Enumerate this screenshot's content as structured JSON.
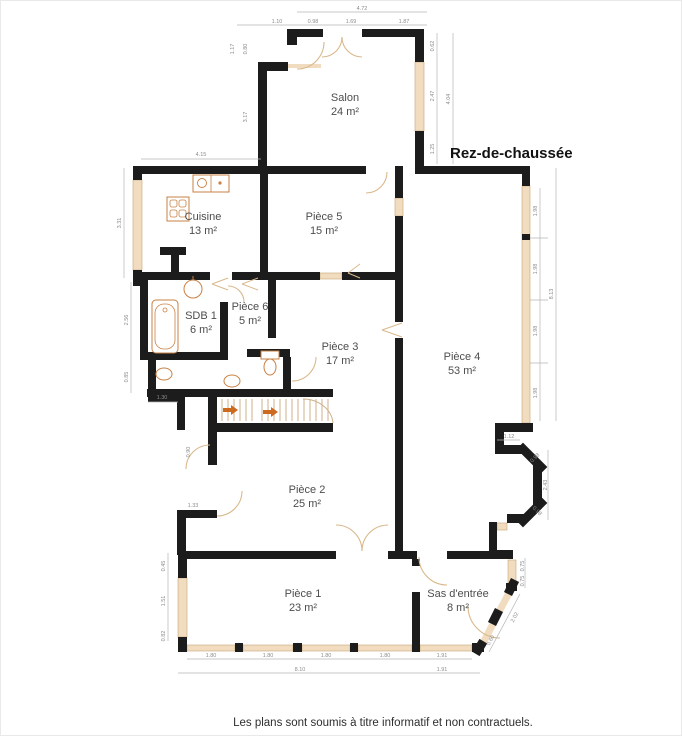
{
  "title": "Rez-de-chaussée",
  "disclaimer": "Les plans sont soumis à titre informatif et non contractuels.",
  "colors": {
    "wall": "#1c1c1c",
    "window": "#f2dcc0",
    "window_border": "#c3a678",
    "door": "#d9b98c",
    "fixture": "#c98145",
    "stair_stripe": "#cdb08a",
    "arrow": "#cc6a1f",
    "dim_line": "#b5b5b5",
    "dim_text": "#8c8c8c",
    "room_text": "#4d4d4d"
  },
  "rooms": [
    {
      "name": "Salon",
      "area": "24 m²",
      "x": 345,
      "y": 101
    },
    {
      "name": "Cuisine",
      "area": "13 m²",
      "x": 203,
      "y": 220
    },
    {
      "name": "Pièce 5",
      "area": "15 m²",
      "x": 324,
      "y": 220
    },
    {
      "name": "SDB 1",
      "area": "6 m²",
      "x": 201,
      "y": 319
    },
    {
      "name": "Pièce 6",
      "area": "5 m²",
      "x": 250,
      "y": 310
    },
    {
      "name": "Pièce 3",
      "area": "17 m²",
      "x": 340,
      "y": 350
    },
    {
      "name": "Pièce 4",
      "area": "53 m²",
      "x": 462,
      "y": 360
    },
    {
      "name": "Pièce 2",
      "area": "25 m²",
      "x": 307,
      "y": 493
    },
    {
      "name": "Pièce 1",
      "area": "23 m²",
      "x": 303,
      "y": 597
    },
    {
      "name": "Sas d'entrée",
      "area": "8 m²",
      "x": 458,
      "y": 597
    }
  ],
  "dimensions": [
    {
      "t": "4.72",
      "x": 362,
      "y": 10,
      "r": 0
    },
    {
      "t": "1.10",
      "x": 277,
      "y": 23,
      "r": 0
    },
    {
      "t": "0.98",
      "x": 313,
      "y": 23,
      "r": 0
    },
    {
      "t": "1.69",
      "x": 351,
      "y": 23,
      "r": 0
    },
    {
      "t": "1.87",
      "x": 404,
      "y": 23,
      "r": 0
    },
    {
      "t": "1.17",
      "x": 234,
      "y": 49,
      "r": -90
    },
    {
      "t": "0.80",
      "x": 247,
      "y": 49,
      "r": -90
    },
    {
      "t": "3.17",
      "x": 247,
      "y": 117,
      "r": -90
    },
    {
      "t": "4.15",
      "x": 201,
      "y": 156,
      "r": 0
    },
    {
      "t": "3.31",
      "x": 121,
      "y": 223,
      "r": -90
    },
    {
      "t": "2.56",
      "x": 128,
      "y": 320,
      "r": -90
    },
    {
      "t": "0.85",
      "x": 128,
      "y": 377,
      "r": -90
    },
    {
      "t": "1.30",
      "x": 162,
      "y": 399,
      "r": 0
    },
    {
      "t": "0.62",
      "x": 434,
      "y": 46,
      "r": -90
    },
    {
      "t": "2.47",
      "x": 434,
      "y": 96,
      "r": -90
    },
    {
      "t": "1.25",
      "x": 434,
      "y": 149,
      "r": -90
    },
    {
      "t": "4.04",
      "x": 450,
      "y": 99,
      "r": -90
    },
    {
      "t": "1.98",
      "x": 537,
      "y": 211,
      "r": -90
    },
    {
      "t": "1.98",
      "x": 537,
      "y": 269,
      "r": -90
    },
    {
      "t": "1.98",
      "x": 537,
      "y": 331,
      "r": -90
    },
    {
      "t": "1.98",
      "x": 537,
      "y": 393,
      "r": -90
    },
    {
      "t": "8.13",
      "x": 553,
      "y": 294,
      "r": -90
    },
    {
      "t": "1.12",
      "x": 509,
      "y": 438,
      "r": 0
    },
    {
      "t": "0.98",
      "x": 536,
      "y": 459,
      "r": -45
    },
    {
      "t": "2.43",
      "x": 547,
      "y": 485,
      "r": -90
    },
    {
      "t": "0.98",
      "x": 536,
      "y": 512,
      "r": 45
    },
    {
      "t": "0.75",
      "x": 524,
      "y": 566,
      "r": -90
    },
    {
      "t": "0.75",
      "x": 524,
      "y": 581,
      "r": -90
    },
    {
      "t": "2.02",
      "x": 516,
      "y": 618,
      "r": -62
    },
    {
      "t": "0.60",
      "x": 492,
      "y": 641,
      "r": -62
    },
    {
      "t": "0.90",
      "x": 190,
      "y": 452,
      "r": -90
    },
    {
      "t": "1.33",
      "x": 193,
      "y": 507,
      "r": 0
    },
    {
      "t": "0.45",
      "x": 165,
      "y": 566,
      "r": -90
    },
    {
      "t": "1.51",
      "x": 165,
      "y": 601,
      "r": -90
    },
    {
      "t": "0.82",
      "x": 165,
      "y": 636,
      "r": -90
    },
    {
      "t": "1.80",
      "x": 211,
      "y": 657,
      "r": 0
    },
    {
      "t": "1.80",
      "x": 268,
      "y": 657,
      "r": 0
    },
    {
      "t": "1.80",
      "x": 326,
      "y": 657,
      "r": 0
    },
    {
      "t": "1.80",
      "x": 385,
      "y": 657,
      "r": 0
    },
    {
      "t": "1.91",
      "x": 442,
      "y": 657,
      "r": 0
    },
    {
      "t": "8.10",
      "x": 300,
      "y": 671,
      "r": 0
    },
    {
      "t": "1.91",
      "x": 442,
      "y": 671,
      "r": 0
    }
  ],
  "plan": {
    "walls": [
      [
        287,
        29,
        36,
        8
      ],
      [
        362,
        29,
        54,
        8
      ],
      [
        287,
        29,
        10,
        16
      ],
      [
        258,
        62,
        30,
        9
      ],
      [
        258,
        62,
        9,
        111
      ],
      [
        415,
        29,
        9,
        33
      ],
      [
        415,
        131,
        9,
        42
      ],
      [
        415,
        166,
        112,
        8
      ],
      [
        140,
        166,
        226,
        8
      ],
      [
        133,
        166,
        9,
        14
      ],
      [
        133,
        270,
        9,
        16
      ],
      [
        260,
        166,
        8,
        109
      ],
      [
        395,
        166,
        8,
        32
      ],
      [
        395,
        216,
        8,
        106
      ],
      [
        395,
        338,
        8,
        217
      ],
      [
        133,
        272,
        77,
        8
      ],
      [
        232,
        272,
        88,
        8
      ],
      [
        342,
        272,
        54,
        8
      ],
      [
        140,
        280,
        8,
        80
      ],
      [
        220,
        302,
        8,
        56
      ],
      [
        268,
        280,
        8,
        58
      ],
      [
        148,
        352,
        80,
        8
      ],
      [
        247,
        349,
        43,
        8
      ],
      [
        283,
        357,
        8,
        34
      ],
      [
        148,
        360,
        8,
        42
      ],
      [
        148,
        394,
        32,
        8
      ],
      [
        177,
        394,
        8,
        36
      ],
      [
        160,
        247,
        26,
        8
      ],
      [
        171,
        255,
        8,
        20
      ],
      [
        147,
        389,
        186,
        8
      ],
      [
        217,
        423,
        116,
        9
      ],
      [
        208,
        397,
        9,
        68
      ],
      [
        208,
        511,
        9,
        7
      ],
      [
        177,
        510,
        40,
        8
      ],
      [
        177,
        518,
        9,
        37
      ],
      [
        178,
        551,
        158,
        8
      ],
      [
        388,
        551,
        29,
        8
      ],
      [
        447,
        551,
        66,
        8
      ],
      [
        497,
        550,
        16,
        8
      ],
      [
        178,
        559,
        9,
        19
      ],
      [
        178,
        637,
        9,
        15
      ],
      [
        178,
        643,
        9,
        9
      ],
      [
        235,
        643,
        8,
        9
      ],
      [
        293,
        643,
        9,
        9
      ],
      [
        350,
        643,
        8,
        9
      ],
      [
        412,
        643,
        8,
        9
      ],
      [
        472,
        643,
        12,
        9
      ],
      [
        412,
        559,
        8,
        7
      ],
      [
        412,
        592,
        8,
        51
      ],
      [
        522,
        166,
        8,
        20
      ],
      [
        522,
        234,
        8,
        6
      ],
      [
        495,
        423,
        38,
        9
      ],
      [
        495,
        432,
        9,
        20
      ],
      [
        495,
        445,
        30,
        9
      ],
      [
        533,
        465,
        9,
        40
      ],
      [
        507,
        514,
        20,
        9
      ],
      [
        489,
        522,
        8,
        33
      ],
      [
        506,
        583,
        11,
        8
      ]
    ],
    "windows": [
      [
        133,
        180,
        9,
        90
      ],
      [
        415,
        62,
        9,
        69
      ],
      [
        522,
        186,
        8,
        237
      ],
      [
        395,
        198,
        8,
        18
      ],
      [
        320,
        273,
        22,
        6
      ],
      [
        178,
        578,
        9,
        59
      ],
      [
        508,
        560,
        8,
        24
      ],
      [
        497,
        523,
        10,
        7
      ],
      [
        187,
        645,
        48,
        6
      ],
      [
        243,
        645,
        50,
        6
      ],
      [
        302,
        645,
        48,
        6
      ],
      [
        358,
        645,
        54,
        6
      ],
      [
        420,
        645,
        52,
        6
      ]
    ],
    "diagWalls": [
      [
        523,
        449,
        541,
        467,
        9
      ],
      [
        541,
        503,
        523,
        521,
        9
      ],
      [
        513,
        584,
        510,
        590,
        9
      ],
      [
        497,
        614,
        494,
        620,
        9
      ],
      [
        481,
        645,
        478,
        650,
        9
      ]
    ],
    "diagWindows": [
      [
        288,
        66,
        321,
        66,
        4
      ],
      [
        511,
        589,
        499,
        612,
        7
      ],
      [
        495,
        620,
        483,
        643,
        7
      ]
    ],
    "doorArcs": [
      "M 324,42 A 27,27 0 0 1 297,69",
      "M 342,37 A 20,20 0 0 1 322,57",
      "M 362,57 A 20,20 0 0 1 342,37",
      "M 387,172 A 21,21 0 0 1 366,193",
      "M 244,302 A 16,16 0 0 0 228,286",
      "M 292,381 A 24,24 0 0 0 316,357",
      "M 242,491 A 25,25 0 0 1 217,516",
      "M 186,469 A 24,24 0 0 1 210,445",
      "M 336,525 A 26,26 0 0 1 362,551",
      "M 362,551 A 26,26 0 0 1 388,525",
      "M 419,557 A 28,28 0 0 0 447,585",
      "M 468,606 A 32,32 0 0 0 500,638"
    ],
    "angleDoors": [
      [
        228,
        278,
        212,
        284,
        228,
        290
      ],
      [
        258,
        278,
        242,
        284,
        258,
        290
      ],
      [
        402,
        323,
        382,
        330,
        402,
        337
      ],
      [
        360,
        264,
        348,
        273,
        360,
        278
      ]
    ],
    "stairs": {
      "bands": [
        [
          222,
          252
        ],
        [
          262,
          328
        ]
      ],
      "y1": 399,
      "y2": 421,
      "step": 6,
      "winder": "M 303,399 A 30,26 0 0 1 333,423",
      "arrows": [
        [
          223,
          410
        ],
        [
          263,
          412
        ]
      ]
    },
    "dimLines": [
      [
        297,
        12,
        427,
        12
      ],
      [
        237,
        25,
        427,
        25
      ],
      [
        141,
        159,
        261,
        159
      ],
      [
        124,
        168,
        124,
        278
      ],
      [
        131,
        282,
        131,
        393
      ],
      [
        148,
        402,
        178,
        402
      ],
      [
        437,
        33,
        437,
        164
      ],
      [
        453,
        33,
        453,
        164
      ],
      [
        540,
        188,
        540,
        421
      ],
      [
        556,
        168,
        556,
        421
      ],
      [
        530,
        238,
        548,
        238
      ],
      [
        530,
        300,
        548,
        300
      ],
      [
        530,
        363,
        548,
        363
      ],
      [
        497,
        440,
        520,
        440
      ],
      [
        548,
        450,
        548,
        520
      ],
      [
        525,
        558,
        525,
        588
      ],
      [
        520,
        594,
        489,
        652
      ],
      [
        168,
        553,
        168,
        641
      ],
      [
        187,
        659,
        420,
        659
      ],
      [
        420,
        659,
        472,
        659
      ],
      [
        178,
        673,
        430,
        673
      ],
      [
        430,
        673,
        480,
        673
      ]
    ],
    "fixtures": [
      {
        "type": "kitchen",
        "x": 193,
        "y": 175
      },
      {
        "type": "stove",
        "x": 167,
        "y": 197
      },
      {
        "type": "tub",
        "x": 152,
        "y": 300
      },
      {
        "type": "sink",
        "x": 193,
        "y": 289
      },
      {
        "type": "toilet",
        "x": 261,
        "y": 351
      },
      {
        "type": "basin",
        "x": 232,
        "y": 381
      },
      {
        "type": "basin",
        "x": 164,
        "y": 374
      }
    ]
  }
}
